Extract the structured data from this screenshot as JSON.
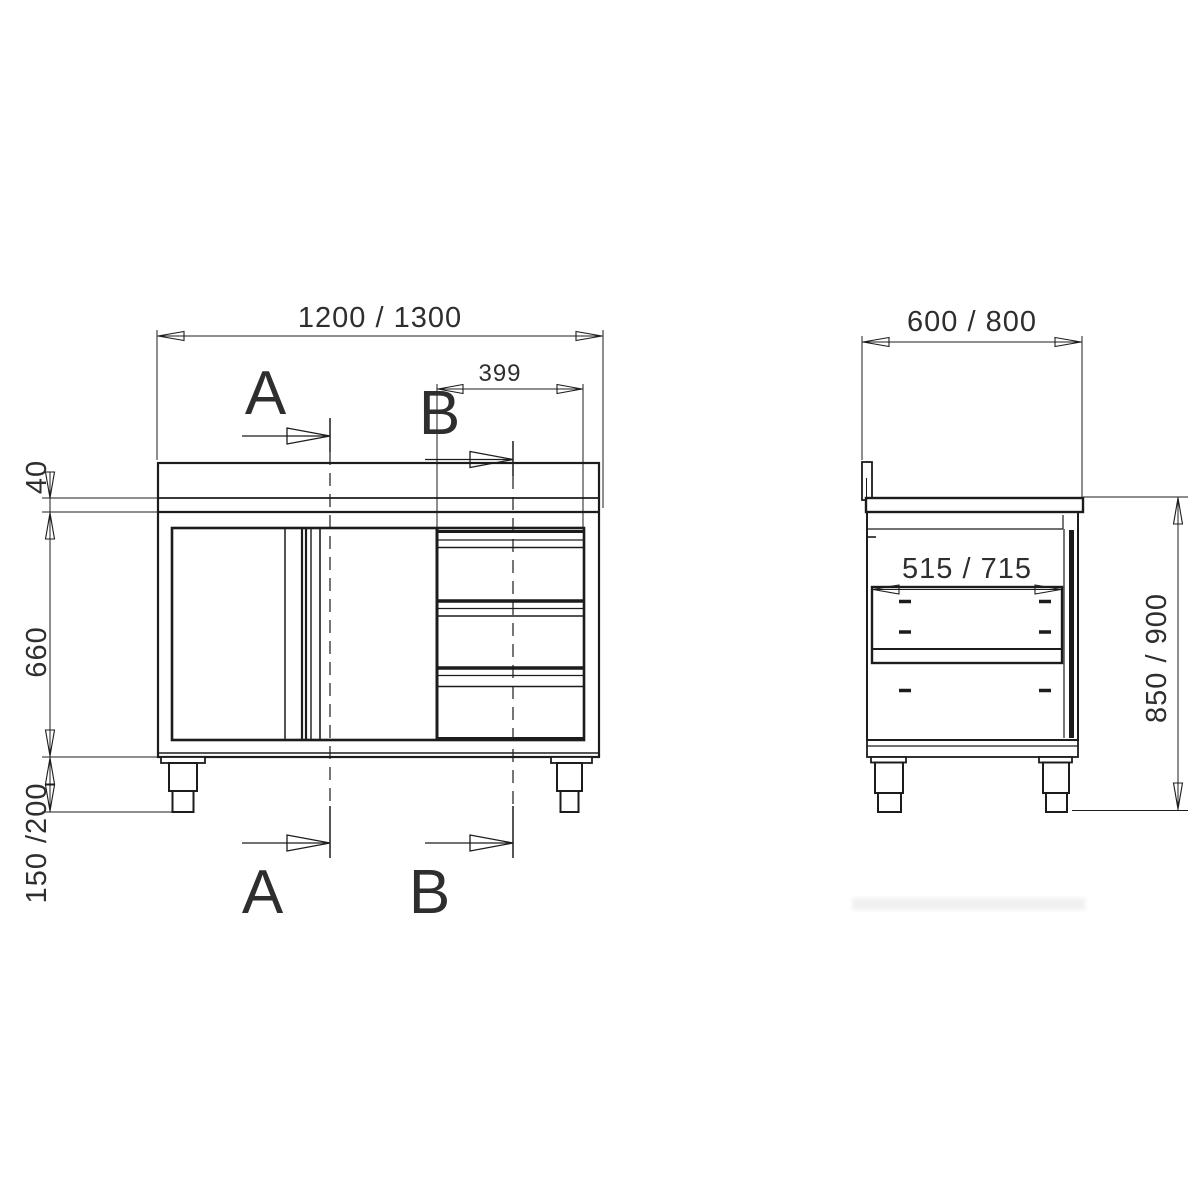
{
  "meta": {
    "background_color": "#ffffff",
    "line_color": "#1c1c1c",
    "text_color": "#2e2e2e"
  },
  "front_view": {
    "overall_width_dim": "1200 / 1300",
    "drawer_unit_width_dim": "399",
    "worktop_thickness_dim": "40",
    "body_height_dim": "660",
    "leg_height_dim": "150 /200",
    "section_a_label": "A",
    "section_b_label": "B"
  },
  "side_view": {
    "overall_depth_dim": "600 / 800",
    "inner_depth_dim": "515 / 715",
    "overall_height_dim": "850 / 900"
  }
}
